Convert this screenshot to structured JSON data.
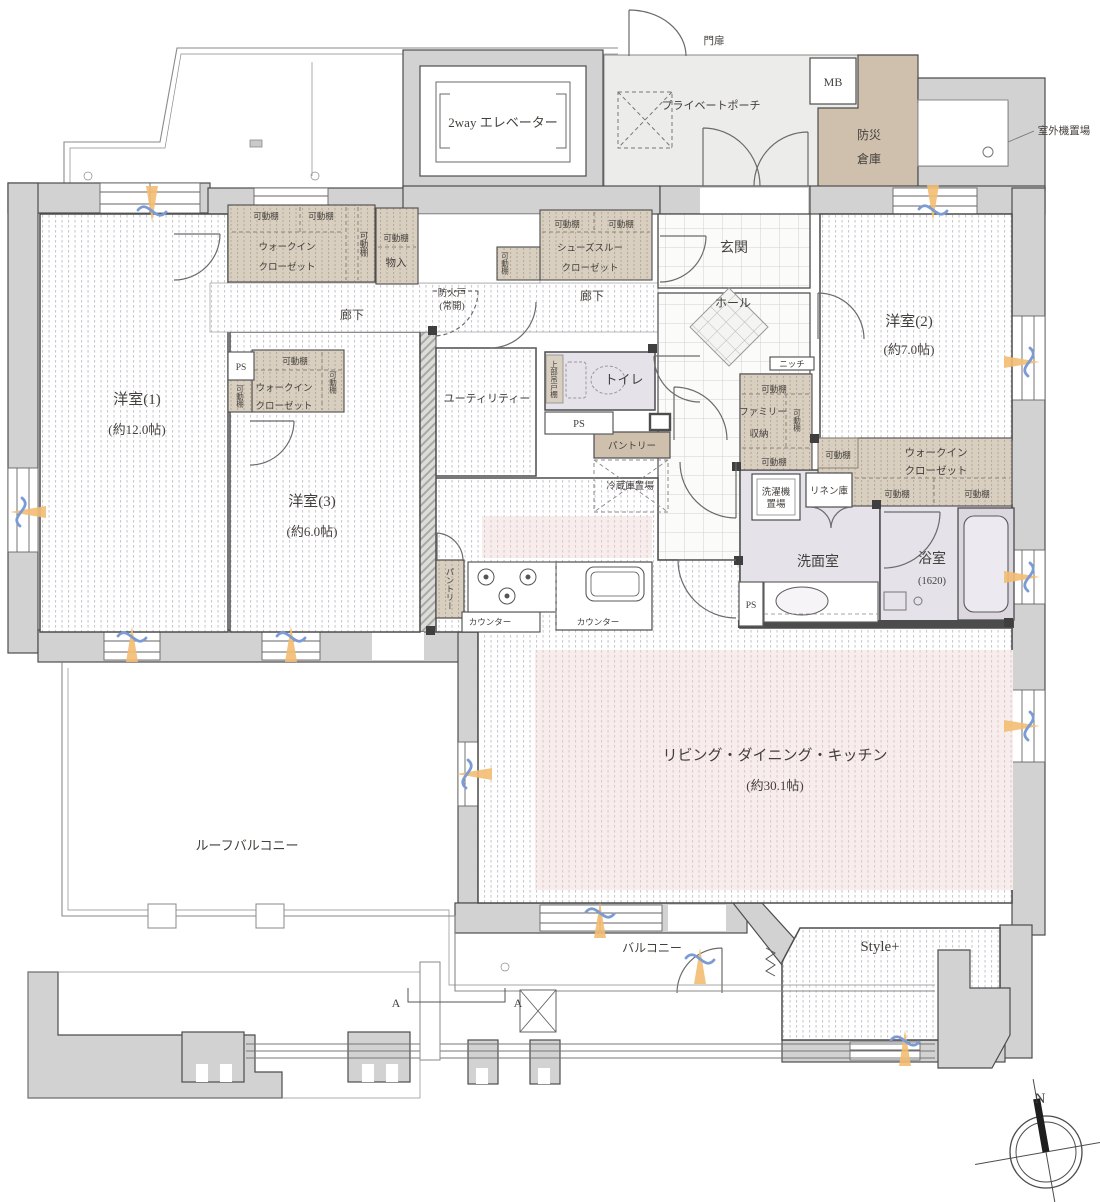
{
  "colors": {
    "wall_fill": "#d2d2d2",
    "wall_line": "#4c4c4c",
    "closet_fill": "#d9cfc1",
    "storage_brown": "#cfc0ae",
    "wet_room_fill": "#e6e2ea",
    "ldk_pink": "#f8eded",
    "porch_fill": "#ececea",
    "accent_orange": "#f3bd72",
    "accent_blue": "#7b9bd4",
    "text": "#433f3b"
  },
  "exterior": {
    "gate": "門扉",
    "elevator": "2way エレベーター",
    "private_porch": "プライベートポーチ",
    "mb": "MB",
    "disaster_storage_l1": "防災",
    "disaster_storage_l2": "倉庫",
    "outdoor_unit": "室外機置場",
    "roof_balcony": "ルーフバルコニー",
    "balcony": "バルコニー",
    "style_plus": "Style+"
  },
  "rooms": {
    "bedroom1": {
      "name": "洋室(1)",
      "size": "(約12.0帖)"
    },
    "bedroom2": {
      "name": "洋室(2)",
      "size": "(約7.0帖)"
    },
    "bedroom3": {
      "name": "洋室(3)",
      "size": "(約6.0帖)"
    },
    "ldk": {
      "name": "リビング・ダイニング・キッチン",
      "size": "(約30.1帖)"
    },
    "genkan": "玄関",
    "hall": "ホール",
    "corridor": "廊下",
    "utility": "ユーティリティー",
    "toilet": "トイレ",
    "washroom": "洗面室",
    "bath": {
      "name": "浴室",
      "size": "(1620)"
    }
  },
  "storage": {
    "shelf": "可動棚",
    "wic_l1": "ウォークイン",
    "wic_l2": "クローゼット",
    "shoes_l1": "シューズスルー",
    "shoes_l2": "クローゼット",
    "closet": "物入",
    "pantry": "パントリー",
    "family_l1": "ファミリー",
    "family_l2": "収納",
    "linen": "リネン庫",
    "upper_cabinet": "上部吊戸棚",
    "fridge": "冷蔵庫置場",
    "laundry_l1": "洗濯機",
    "laundry_l2": "置場",
    "niche": "ニッチ",
    "counter": "カウンター",
    "ps": "PS"
  },
  "annotations": {
    "fire_door_l1": "防火戸",
    "fire_door_l2": "(常開)",
    "section": "A",
    "north": "N"
  }
}
